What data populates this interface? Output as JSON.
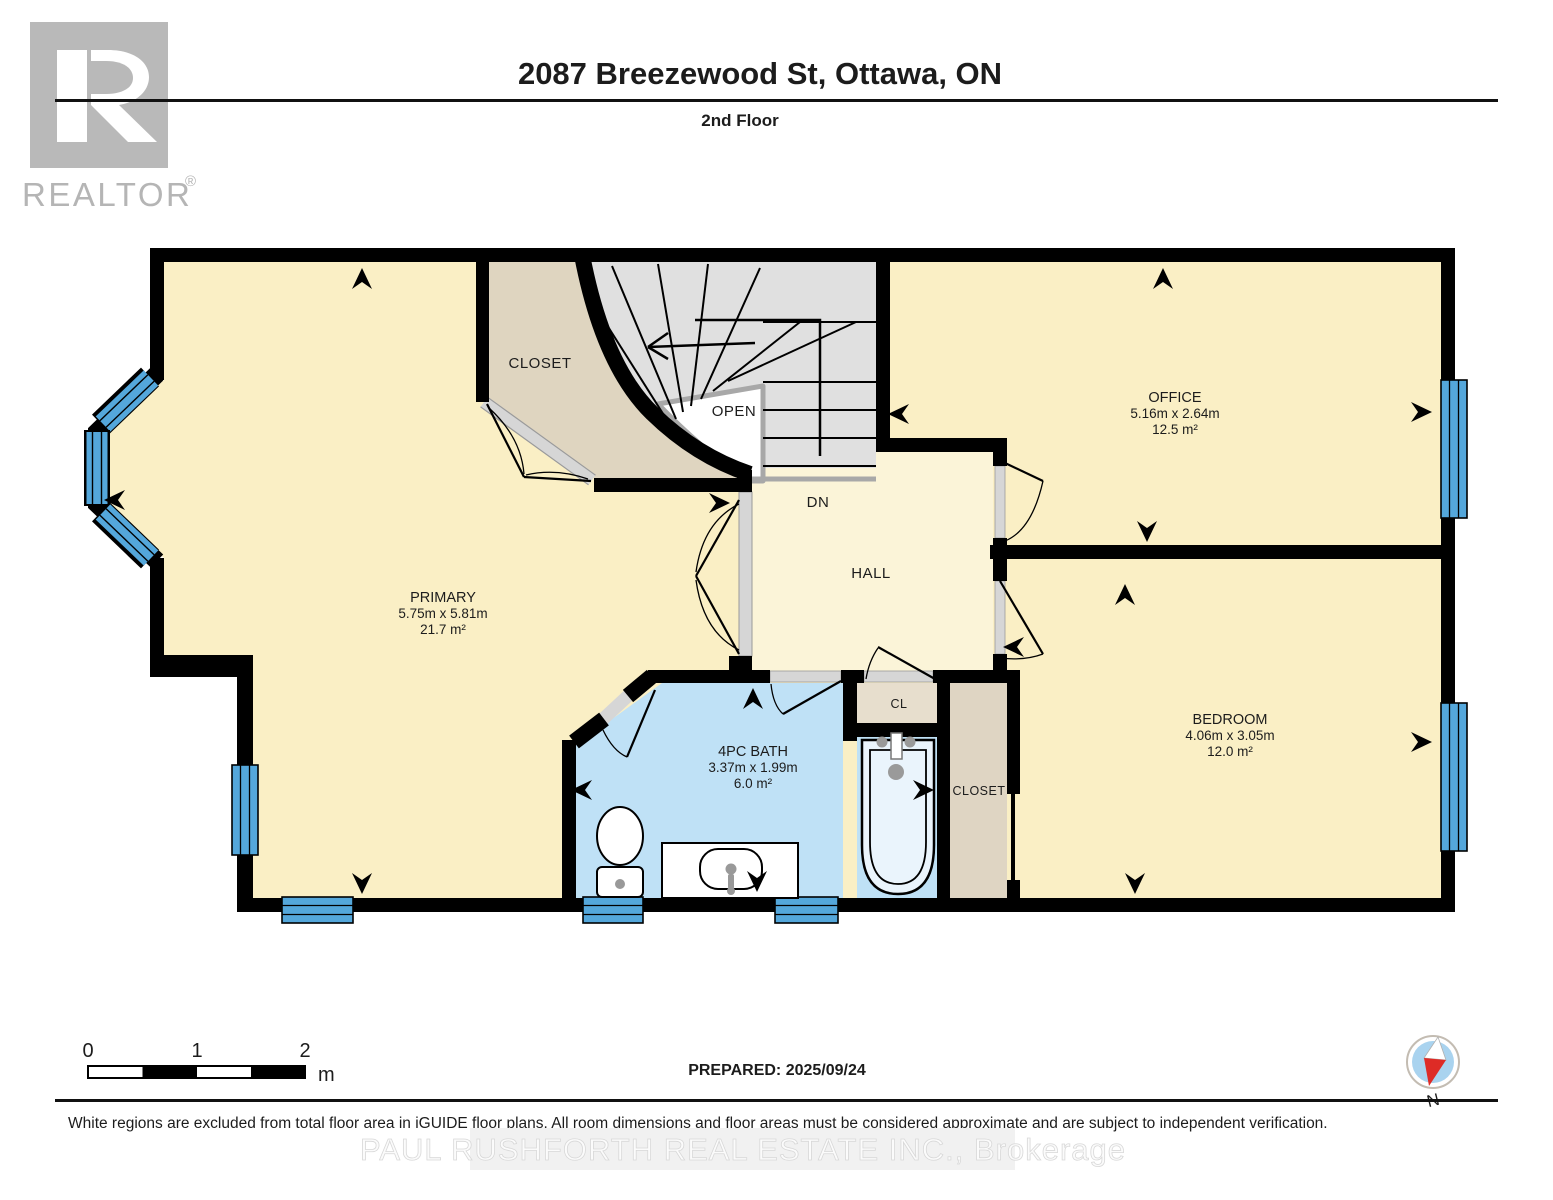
{
  "header": {
    "title": "2087 Breezewood St, Ottawa, ON",
    "subtitle": "2nd Floor"
  },
  "branding": {
    "logo_text": "REALTOR",
    "registered": "®"
  },
  "plan": {
    "rooms": {
      "primary": {
        "name": "PRIMARY",
        "dims": "5.75m x 5.81m",
        "area": "21.7 m²"
      },
      "office": {
        "name": "OFFICE",
        "dims": "5.16m x 2.64m",
        "area": "12.5 m²"
      },
      "bedroom": {
        "name": "BEDROOM",
        "dims": "4.06m x 3.05m",
        "area": "12.0 m²"
      },
      "bath": {
        "name": "4PC BATH",
        "dims": "3.37m x 1.99m",
        "area": "6.0 m²"
      }
    },
    "labels": {
      "closet_top": "CLOSET",
      "open": "OPEN",
      "dn": "DN",
      "hall": "HALL",
      "cl": "CL",
      "closet_right": "CLOSET"
    }
  },
  "scale_bar": {
    "tick_0": "0",
    "tick_1": "1",
    "tick_2": "2",
    "unit": "m"
  },
  "compass": {
    "north_label": "N"
  },
  "footer": {
    "prepared": "PREPARED: 2025/09/24",
    "disclaimer": "White regions are excluded from total floor area in iGUIDE floor plans. All room dimensions and floor areas must be considered approximate and are subject to independent verification.",
    "watermark": "PAUL RUSHFORTH REAL ESTATE INC., Brokerage"
  },
  "colors": {
    "wall": "#000000",
    "floor_cream": "#FAEFC5",
    "hall_cream": "#FBF4D8",
    "bath_blue": "#BFE1F6",
    "closet_tan": "#DFD5C0",
    "stairs_gray": "#E0E0E0",
    "window_blue": "#54A7DB",
    "threshold_gray": "#D6D6D6",
    "compass_red": "#DE2B26",
    "compass_blue": "#A9D3EF",
    "logo_gray": "#B9B9B9"
  }
}
